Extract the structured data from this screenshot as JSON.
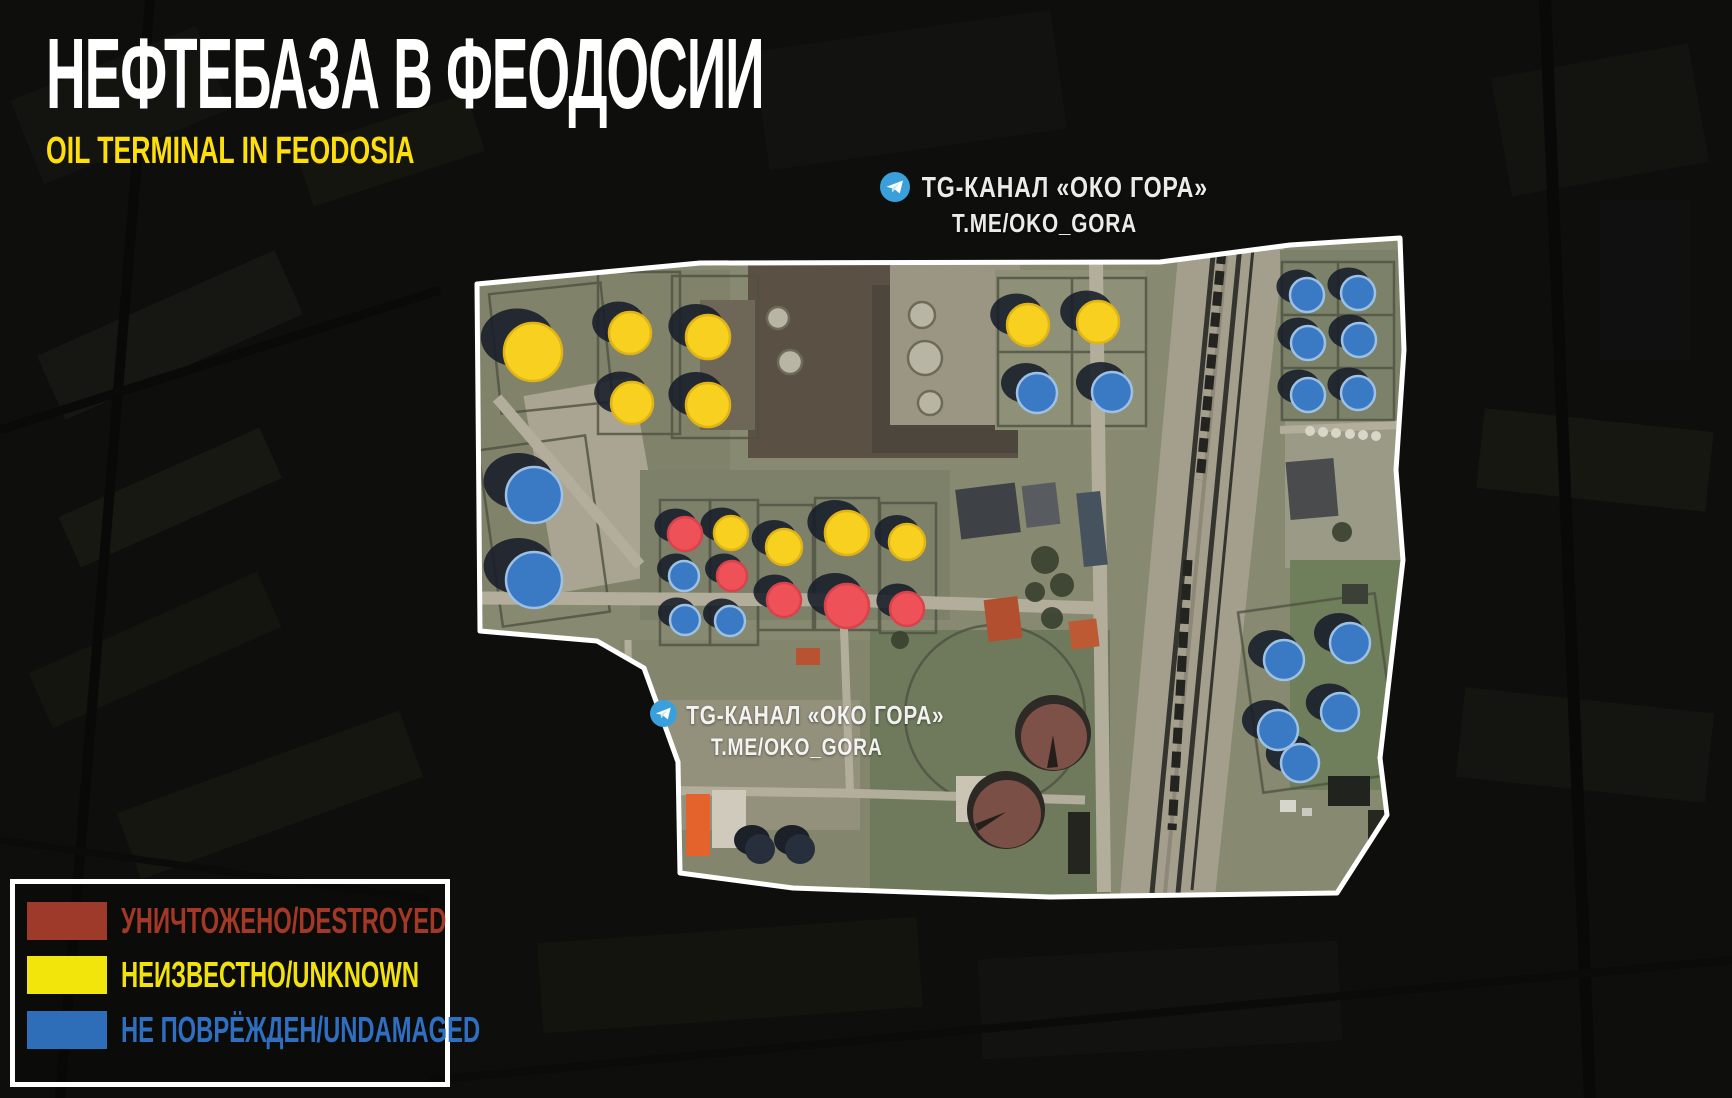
{
  "header": {
    "title": "НЕФТЕБАЗА В ФЕОДОСИИ",
    "subtitle": "OIL TERMINAL IN FEODOSIA"
  },
  "watermark": {
    "channel": "TG-КАНАЛ «ОКО ГОРА»",
    "handle": "T.ME/OKO_GORA",
    "icon": "telegram-icon",
    "icon_color": "#3aa0dc"
  },
  "legend": {
    "items": [
      {
        "status": "destroyed",
        "label": "УНИЧТОЖЕНО/DESTROYED",
        "swatch": "#9d3a29",
        "text_color": "#a33827"
      },
      {
        "status": "unknown",
        "label": "НЕИЗВЕСТНО/UNKNOWN",
        "swatch": "#f2e50b",
        "text_color": "#f2e20c"
      },
      {
        "status": "undamaged",
        "label": "НЕ ПОВРЁЖДЕН/UNDAMAGED",
        "swatch": "#2e6db8",
        "text_color": "#2e6fc2"
      }
    ]
  },
  "map": {
    "marker_colors": {
      "destroyed": "#ee5157",
      "unknown": "#f8d020",
      "undamaged": "#3a7ac4"
    },
    "marker_strokes": {
      "destroyed": "#d7434b",
      "unknown": "#e0b414",
      "undamaged": "#9dc1e4"
    },
    "markers": [
      {
        "x": 533,
        "y": 352,
        "r": 29,
        "status": "unknown"
      },
      {
        "x": 630,
        "y": 333,
        "r": 21,
        "status": "unknown"
      },
      {
        "x": 708,
        "y": 337,
        "r": 22,
        "status": "unknown"
      },
      {
        "x": 632,
        "y": 403,
        "r": 21,
        "status": "unknown"
      },
      {
        "x": 708,
        "y": 405,
        "r": 22,
        "status": "unknown"
      },
      {
        "x": 1028,
        "y": 325,
        "r": 21,
        "status": "unknown"
      },
      {
        "x": 1098,
        "y": 322,
        "r": 21,
        "status": "unknown"
      },
      {
        "x": 731,
        "y": 533,
        "r": 17,
        "status": "unknown"
      },
      {
        "x": 784,
        "y": 547,
        "r": 18,
        "status": "unknown"
      },
      {
        "x": 847,
        "y": 533,
        "r": 22,
        "status": "unknown"
      },
      {
        "x": 907,
        "y": 542,
        "r": 18,
        "status": "unknown"
      },
      {
        "x": 534,
        "y": 495,
        "r": 28,
        "status": "undamaged"
      },
      {
        "x": 534,
        "y": 580,
        "r": 28,
        "status": "undamaged"
      },
      {
        "x": 1037,
        "y": 393,
        "r": 20,
        "status": "undamaged"
      },
      {
        "x": 1112,
        "y": 392,
        "r": 20,
        "status": "undamaged"
      },
      {
        "x": 684,
        "y": 576,
        "r": 15,
        "status": "undamaged"
      },
      {
        "x": 685,
        "y": 620,
        "r": 15,
        "status": "undamaged"
      },
      {
        "x": 730,
        "y": 621,
        "r": 15,
        "status": "undamaged"
      },
      {
        "x": 1307,
        "y": 295,
        "r": 17,
        "status": "undamaged"
      },
      {
        "x": 1358,
        "y": 293,
        "r": 17,
        "status": "undamaged"
      },
      {
        "x": 1308,
        "y": 343,
        "r": 17,
        "status": "undamaged"
      },
      {
        "x": 1359,
        "y": 340,
        "r": 17,
        "status": "undamaged"
      },
      {
        "x": 1308,
        "y": 395,
        "r": 17,
        "status": "undamaged"
      },
      {
        "x": 1358,
        "y": 393,
        "r": 17,
        "status": "undamaged"
      },
      {
        "x": 1284,
        "y": 660,
        "r": 20,
        "status": "undamaged"
      },
      {
        "x": 1350,
        "y": 643,
        "r": 20,
        "status": "undamaged"
      },
      {
        "x": 1278,
        "y": 730,
        "r": 20,
        "status": "undamaged"
      },
      {
        "x": 1340,
        "y": 712,
        "r": 19,
        "status": "undamaged"
      },
      {
        "x": 1300,
        "y": 763,
        "r": 19,
        "status": "undamaged"
      },
      {
        "x": 685,
        "y": 534,
        "r": 17,
        "status": "destroyed"
      },
      {
        "x": 732,
        "y": 576,
        "r": 15,
        "status": "destroyed"
      },
      {
        "x": 784,
        "y": 600,
        "r": 17,
        "status": "destroyed"
      },
      {
        "x": 847,
        "y": 606,
        "r": 22,
        "status": "destroyed"
      },
      {
        "x": 907,
        "y": 609,
        "r": 17,
        "status": "destroyed"
      }
    ]
  }
}
